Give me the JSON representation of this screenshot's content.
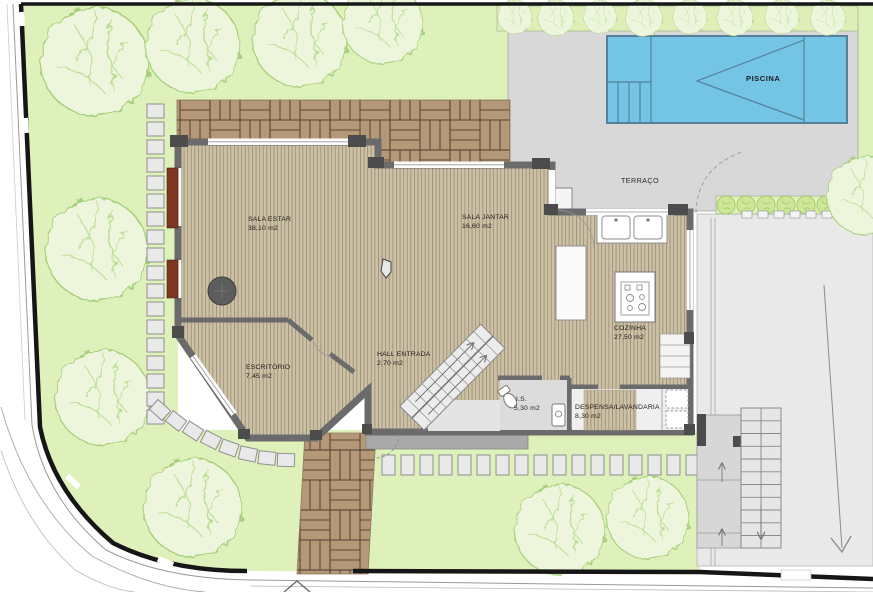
{
  "rooms": {
    "living": {
      "name": "SALA ESTAR",
      "area": "38,10 m2"
    },
    "dining": {
      "name": "SALA JANTAR",
      "area": "16,60 m2"
    },
    "kitchen": {
      "name": "COZINHA",
      "area": "27,50 m2"
    },
    "office": {
      "name": "ESCRITÓRIO",
      "area": "7,45 m2"
    },
    "hall": {
      "name": "HALL ENTRADA",
      "area": "2,70 m2"
    },
    "wc": {
      "name": "I.S.",
      "area": "5,30 m2"
    },
    "pantry": {
      "name": "DESPENSA/LAVANDARIA",
      "area": "8,30 m2"
    }
  },
  "outdoor": {
    "terrace": "TERRAÇO",
    "pool": "PISCINA"
  },
  "colors": {
    "grass": "#dff1ba",
    "tree": "#edf6dc",
    "wood": "#cdc1a5",
    "paving": "#b59878",
    "terrace": "#d8d8d8",
    "driveway": "#e9e9e9",
    "pool": "#74c4e6",
    "wall": "#6b6b6b",
    "boundary": "#161616",
    "shutter": "#7c3722"
  }
}
